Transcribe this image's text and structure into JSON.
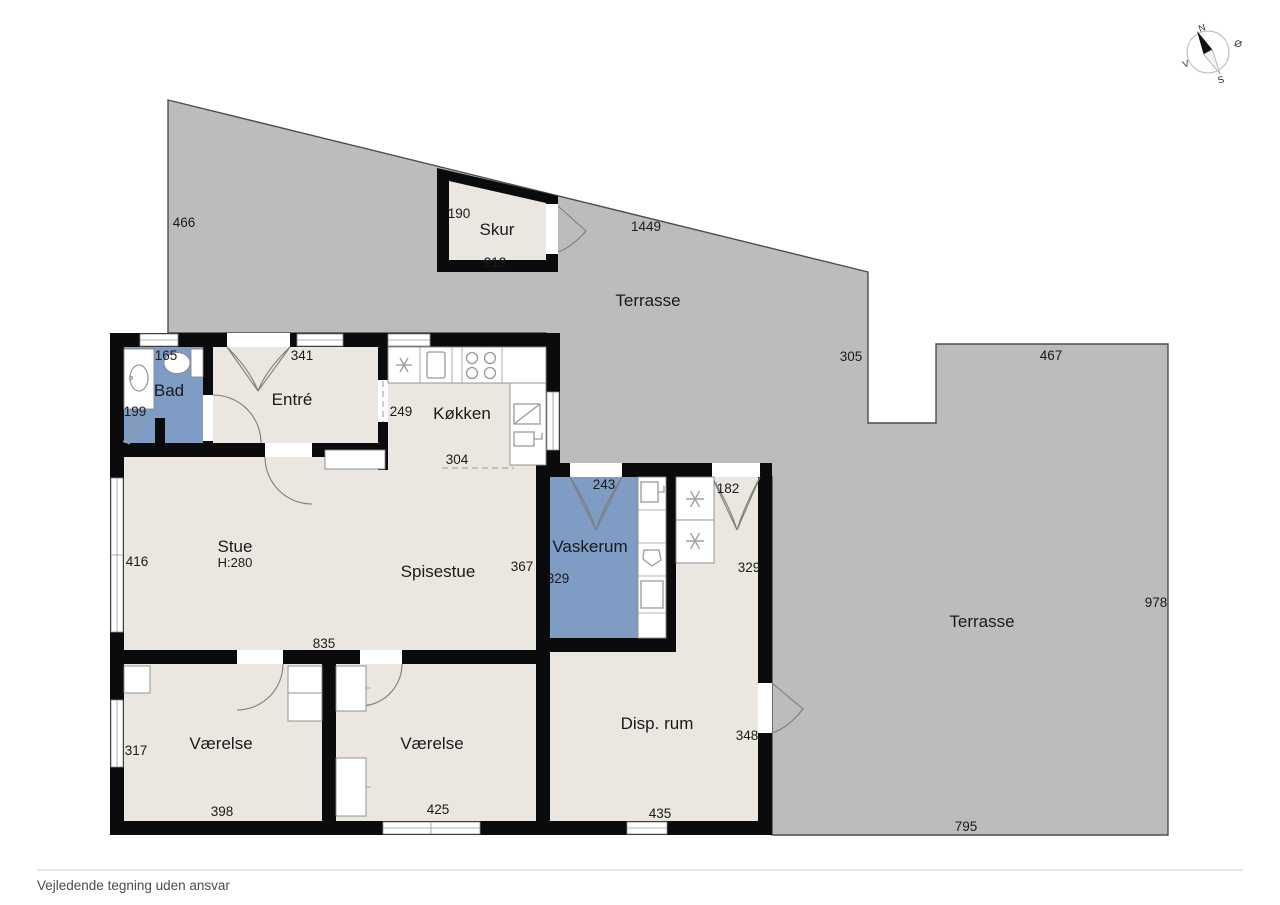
{
  "footer": {
    "disclaimer": "Vejledende tegning uden ansvar"
  },
  "compass": {
    "north": "N",
    "east": "Ø",
    "south": "S",
    "west": "V"
  },
  "colors": {
    "terrace": "#bcbcbc",
    "terrace_outline": "#4d4d4d",
    "floor": "#ebe6df",
    "wet_room": "#7e9cc4",
    "wall": "#0b0b0b"
  },
  "rooms": {
    "skur": {
      "label": "Skur"
    },
    "terrasse_top": {
      "label": "Terrasse"
    },
    "terrasse_right": {
      "label": "Terrasse"
    },
    "bad": {
      "label": "Bad"
    },
    "entre": {
      "label": "Entré"
    },
    "kokken": {
      "label": "Køkken"
    },
    "stue": {
      "label": "Stue",
      "height": "H:280"
    },
    "spisestue": {
      "label": "Spisestue"
    },
    "vaskerum": {
      "label": "Vaskerum"
    },
    "vaerelse_left": {
      "label": "Værelse"
    },
    "vaerelse_right": {
      "label": "Værelse"
    },
    "disp_rum": {
      "label": "Disp. rum"
    }
  },
  "dims": {
    "terrace_left": "466",
    "terrace_slant": "1449",
    "terrace_notch_side": "305",
    "terrace_right_top": "467",
    "terrace_right_side": "978",
    "terrace_right_bottom": "795",
    "skur_side": "190",
    "skur_bottom": "212",
    "bad_top": "165",
    "bad_side": "199",
    "entre_top": "341",
    "kokken_side": "249",
    "kokken_bottom": "304",
    "vaskerum_top": "243",
    "vaskerum_side": "329",
    "disp_top_door": "182",
    "disp_upper_side": "329",
    "disp_side": "348",
    "disp_bottom": "435",
    "stue_side": "416",
    "stue_bottom": "835",
    "spisestue_side": "367",
    "vaerelse_left_side": "317",
    "vaerelse_left_bottom": "398",
    "vaerelse_right_bottom": "425"
  }
}
